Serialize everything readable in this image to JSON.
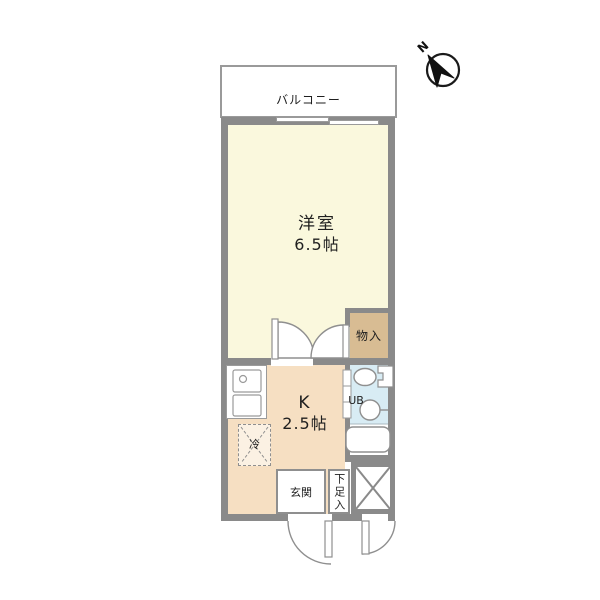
{
  "plan_type": "apartment-floor-plan",
  "compass": {
    "label": "N"
  },
  "rooms": {
    "balcony": {
      "label": "バルコニー"
    },
    "western_room": {
      "label": "洋室",
      "size": "6.5帖"
    },
    "kitchen": {
      "label": "K",
      "size": "2.5帖"
    },
    "closet": {
      "label": "物入"
    },
    "unit_bath": {
      "label": "UB"
    },
    "entrance": {
      "label": "玄関"
    },
    "shoe_cabinet": {
      "label": "下足入"
    },
    "refrigerator": {
      "label": "冷"
    }
  },
  "colors": {
    "wall": "#8a8a8a",
    "line": "#999999",
    "room_cream": "#faf8dd",
    "kitchen_peach": "#f6dfc2",
    "closet_tan": "#d8bc93",
    "bath_blue": "#d8ecf4",
    "text": "#1f1f1f"
  }
}
